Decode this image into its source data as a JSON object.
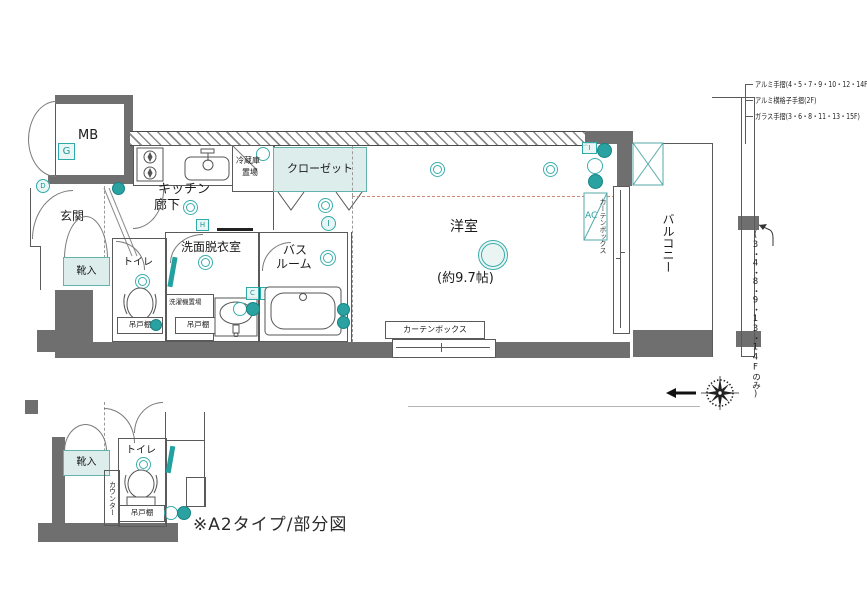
{
  "caption": "※A2タイプ/部分図",
  "right_notes": {
    "railing_1": "アルミ手摺(4・5・7・9・10・12・14F)",
    "railing_2": "アルミ横格子手摺(2F)",
    "railing_3": "ガラス手摺(3・6・8・11・13・15F)",
    "floors_only": "(3・4・8・9・13・14Fのみ)"
  },
  "rooms": {
    "mb": "MB",
    "entrance": "玄関",
    "shoe_cabinet": "靴入",
    "toilet": "トイレ",
    "kitchen_1": "キッチン",
    "kitchen_2": "廊下",
    "fridge_1": "冷蔵庫",
    "fridge_2": "置場",
    "closet": "クローゼット",
    "washroom": "洗面脱衣室",
    "washer_space": "洗濯機置場",
    "bath_1": "バス",
    "bath_2": "ルーム",
    "cupboard": "吊戸棚",
    "western_room": "洋室",
    "western_room_size": "(約9.7帖)",
    "curtain_box": "カーテンボックス",
    "ac": "AC",
    "balcony": "バルコニー",
    "counter": "カウンター"
  },
  "badges": {
    "g": "G",
    "d": "D",
    "h": "H",
    "c": "C",
    "a": "A",
    "i": "I"
  },
  "colors": {
    "wall": "#6f6f6f",
    "accent": "#2aabab",
    "accent_light": "#ddedeb",
    "line": "#555555"
  }
}
